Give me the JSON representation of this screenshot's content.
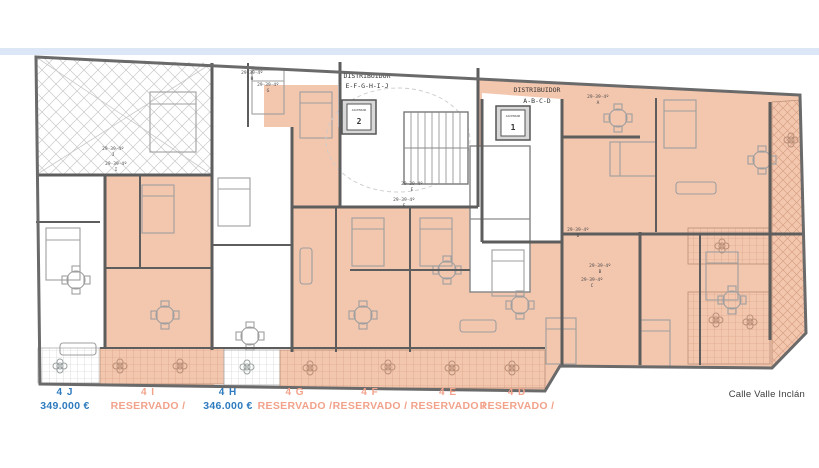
{
  "plan": {
    "street_label": "Calle Valle Inclán",
    "distributor_left": {
      "line1": "DISTRIBUIDOR",
      "line2": "E-F-G-H-I-J"
    },
    "distributor_right": {
      "line1": "DISTRIBUIDOR",
      "line2": "A-B-C-D"
    },
    "elevator_1": {
      "label": "ASCENSOR",
      "number": "1"
    },
    "elevator_2": {
      "label": "ASCENSOR",
      "number": "2"
    },
    "unit_refs": {
      "j": {
        "ref": "29-39-4º",
        "letter": "J"
      },
      "i": {
        "ref": "29-39-4º",
        "letter": "I"
      },
      "h": {
        "ref": "29-39-4º",
        "letter": "H"
      },
      "g": {
        "ref": "29-39-4º",
        "letter": "G"
      },
      "f": {
        "ref": "29-39-4º",
        "letter": "F"
      },
      "e": {
        "ref": "29-39-4º",
        "letter": "E"
      },
      "d": {
        "ref": "29-39-4º",
        "letter": "D"
      },
      "a": {
        "ref": "29-39-4º",
        "letter": "A"
      },
      "b": {
        "ref": "29-39-4º",
        "letter": "B"
      },
      "c": {
        "ref": "29-39-4º",
        "letter": "C"
      }
    },
    "colors": {
      "reserved_fill": "#f3c6ae",
      "available_fill": "#ffffff",
      "wall": "#5d5d5d",
      "price_text": "#2e7bbf",
      "reserved_text": "#f2a28a",
      "divider_band": "#dbe7f6"
    }
  },
  "legend": {
    "items": [
      {
        "code": "4 J",
        "value": "349.000 €",
        "status": "available"
      },
      {
        "code": "4 I",
        "value": "RESERVADO /",
        "status": "reserved"
      },
      {
        "code": "4 H",
        "value": "346.000 €",
        "status": "available"
      },
      {
        "code": "4 G",
        "value": "RESERVADO /",
        "status": "reserved"
      },
      {
        "code": "4 F",
        "value": "RESERVADO /",
        "status": "reserved"
      },
      {
        "code": "4 E",
        "value": "RESERVADO /",
        "status": "reserved"
      },
      {
        "code": "4 D",
        "value": "RESERVADO /",
        "status": "reserved"
      }
    ]
  }
}
